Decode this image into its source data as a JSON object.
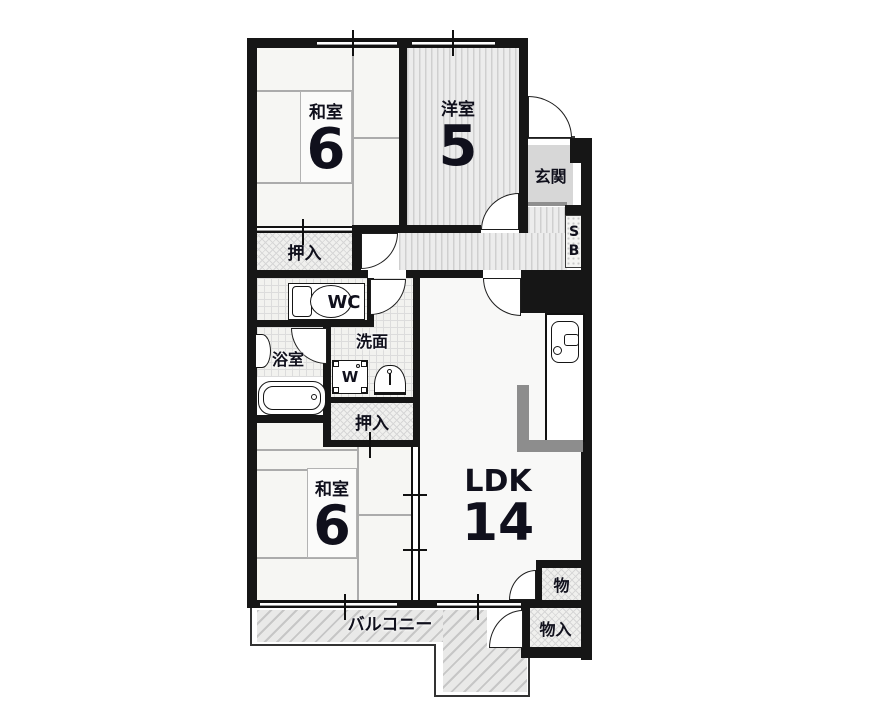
{
  "rooms": {
    "washitsu_top": {
      "name": "和室",
      "size": "6"
    },
    "youshitsu": {
      "name": "洋室",
      "size": "5"
    },
    "genkan": {
      "name": "玄関"
    },
    "shoebox": {
      "top": "S",
      "bottom": "B"
    },
    "oshiire_top": {
      "name": "押入"
    },
    "wc": {
      "name": "WC"
    },
    "senmen": {
      "name": "洗面"
    },
    "yokushitsu": {
      "name": "浴室"
    },
    "washer": {
      "name": "W"
    },
    "oshiire_mid": {
      "name": "押入"
    },
    "washitsu_bottom": {
      "name": "和室",
      "size": "6"
    },
    "ldk": {
      "name": "LDK",
      "size": "14"
    },
    "mono": {
      "name": "物"
    },
    "monoire": {
      "name": "物入"
    },
    "balcony": {
      "name": "バルコニー"
    }
  },
  "colors": {
    "wall": "#161616",
    "genkan_fill": "#d7d7d7",
    "counter_gray": "#8d8d8d",
    "text": "#10101c"
  }
}
